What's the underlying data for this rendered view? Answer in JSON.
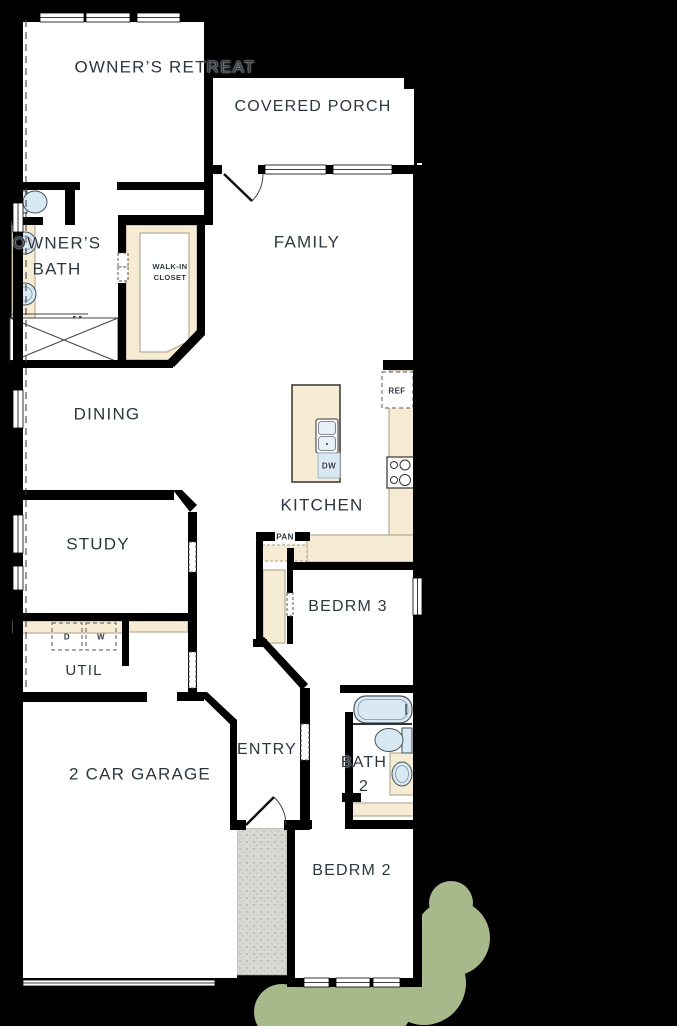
{
  "title": "Single-story house floor plan",
  "labels": {
    "owners_retreat": "OWNER’S RETREAT",
    "covered_porch": "COVERED PORCH",
    "owners_bath": "OWNER’S\nBATH",
    "walk_in_closet": "WALK-IN\nCLOSET",
    "family": "FAMILY",
    "dining": "DINING",
    "kitchen": "KITCHEN",
    "study": "STUDY",
    "bedrm3": "BEDRM 3",
    "util": "UTIL",
    "garage": "2 CAR GARAGE",
    "entry": "ENTRY",
    "bath2": "BATH\n2",
    "bedrm2": "BEDRM 2",
    "refrigerator": "REF",
    "dishwasher": "DW",
    "pantry": "PAN",
    "dryer": "D",
    "washer": "W"
  },
  "colors": {
    "background": "#000000",
    "floor": "#ffffff",
    "wall": "#000000",
    "counter_tan": "#f6ecd3",
    "fixture_blue": "#d8e9f3",
    "walkway_gray": "#d8d7d3",
    "shrub_green": "#a7b98a",
    "label_text": "#2e3640"
  }
}
